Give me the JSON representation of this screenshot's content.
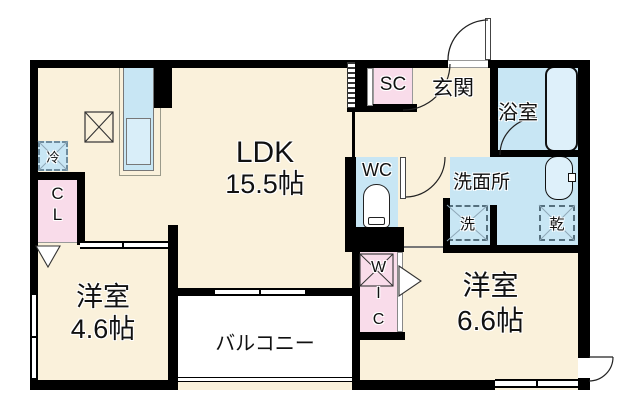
{
  "floorplan": {
    "type": "apartment-floor-plan",
    "rooms": {
      "ldk": {
        "name": "LDK",
        "size": "15.5帖"
      },
      "genkan": {
        "label": "玄関"
      },
      "sc": {
        "label": "SC"
      },
      "bathroom": {
        "label": "浴室"
      },
      "wc": {
        "label": "WC"
      },
      "washroom": {
        "label": "洗面所"
      },
      "cl": {
        "letters": [
          "C",
          "L"
        ]
      },
      "wic": {
        "letters": [
          "W",
          "I",
          "C"
        ]
      },
      "western_small": {
        "name": "洋室",
        "size": "4.6帖"
      },
      "western_large": {
        "name": "洋室",
        "size": "6.6帖"
      },
      "balcony": {
        "label": "バルコニー"
      }
    },
    "fixtures": {
      "fridge": {
        "label": "冷"
      },
      "washer": {
        "label": "洗"
      },
      "dryer": {
        "label": "乾"
      }
    },
    "colors": {
      "floor_cream": "#FAF1DB",
      "wet_area_blue": "#C8E6F4",
      "storage_pink": "#F9DCEA",
      "fixture_blue": "#DEF0FA",
      "wall_black": "#000000",
      "background": "#FFFFFF"
    }
  }
}
